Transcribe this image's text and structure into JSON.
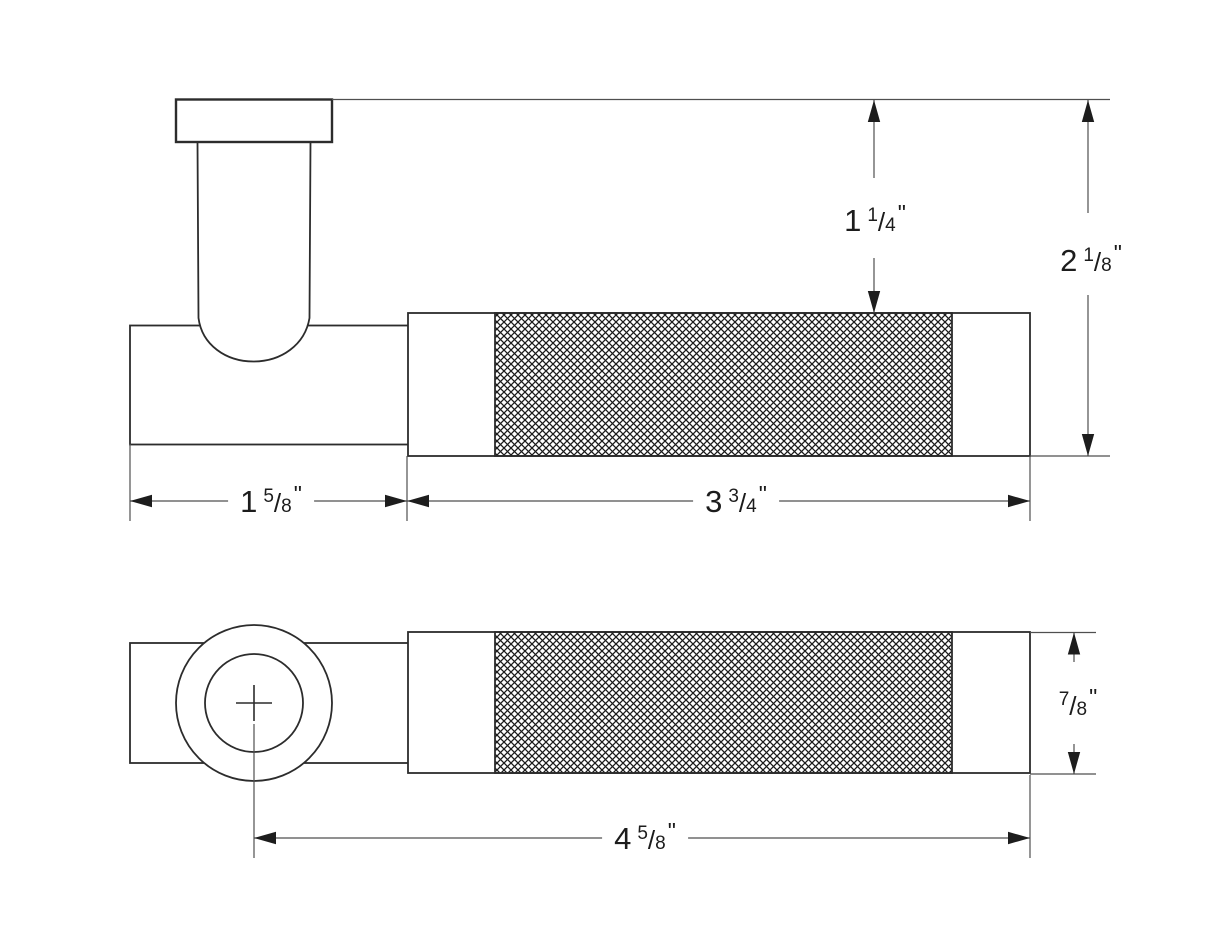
{
  "drawing": {
    "kind": "knurled-lever-handle-technical-drawing",
    "views": [
      "side-elevation",
      "plan"
    ]
  },
  "dimensions": {
    "neck_height": {
      "whole": "1",
      "num": "1",
      "slash": "/",
      "den": "4",
      "unit": "\""
    },
    "overall_height": {
      "whole": "2",
      "num": "1",
      "slash": "/",
      "den": "8",
      "unit": "\""
    },
    "rose_width": {
      "whole": "1",
      "num": "5",
      "slash": "/",
      "den": "8",
      "unit": "\""
    },
    "grip_length": {
      "whole": "3",
      "num": "3",
      "slash": "/",
      "den": "4",
      "unit": "\""
    },
    "bar_diameter": {
      "whole": "",
      "num": "7",
      "slash": "/",
      "den": "8",
      "unit": "\""
    },
    "overall_length": {
      "whole": "4",
      "num": "5",
      "slash": "/",
      "den": "8",
      "unit": "\""
    }
  },
  "colors": {
    "background": "#ffffff",
    "object_line": "#2c2c2c",
    "dimension_line": "#4f4f4f",
    "arrow_fill": "#1d1d1d",
    "hatch_line": "#1b1b1b",
    "text": "#1c1c1c"
  }
}
